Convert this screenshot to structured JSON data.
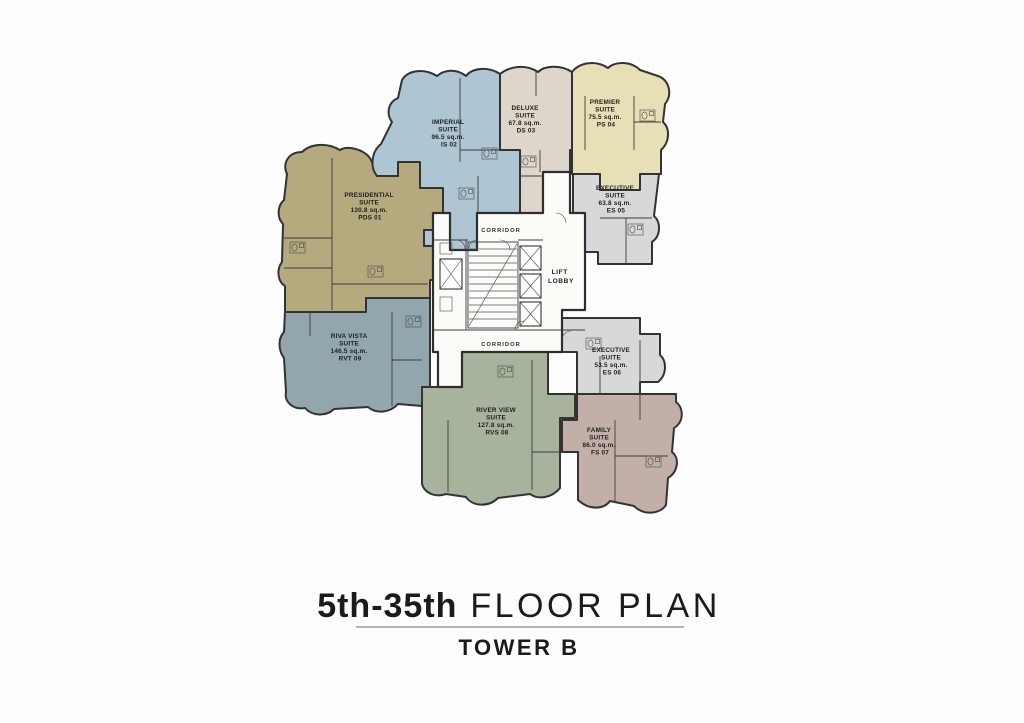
{
  "page": {
    "background_color": "#fdfdfd"
  },
  "title_block": {
    "range": "5th-35th",
    "label": " FLOOR PLAN",
    "tower": "TOWER B"
  },
  "core": {
    "corridor_top": "CORRIDOR",
    "corridor_bottom": "CORRIDOR",
    "lift_lobby": [
      "LIFT",
      "LOBBY"
    ]
  },
  "wall_color": "#333333",
  "units": [
    {
      "id": "presidential-suite",
      "lines": [
        "PRESIDENTIAL",
        "SUITE",
        "130.8 sq.m.",
        "PDS 01"
      ],
      "color": "#b4aa7d"
    },
    {
      "id": "imperial-suite",
      "lines": [
        "IMPERIAL",
        "SUITE",
        "96.5 sq.m.",
        "IS 02"
      ],
      "color": "#aec5d3"
    },
    {
      "id": "deluxe-suite",
      "lines": [
        "DELUXE",
        "SUITE",
        "67.8 sq.m.",
        "DS 03"
      ],
      "color": "#ded6ca"
    },
    {
      "id": "premier-suite",
      "lines": [
        "PREMIER",
        "SUITE",
        "75.5 sq.m.",
        "PS 04"
      ],
      "color": "#e7dfb5"
    },
    {
      "id": "executive-suite-es05",
      "lines": [
        "EXECUTIVE",
        "SUITE",
        "63.8 sq.m.",
        "ES 05"
      ],
      "color": "#d8d8db"
    },
    {
      "id": "executive-suite-es06",
      "lines": [
        "EXECUTIVE",
        "SUITE",
        "53.5 sq.m.",
        "ES 06"
      ],
      "color": "#d8d8db"
    },
    {
      "id": "family-suite",
      "lines": [
        "FAMILY",
        "SUITE",
        "86.0 sq.m.",
        "FS 07"
      ],
      "color": "#c2b0a8"
    },
    {
      "id": "river-view-suite",
      "lines": [
        "RIVER VIEW",
        "SUITE",
        "127.8 sq.m.",
        "RVS 08"
      ],
      "color": "#a8b39e"
    },
    {
      "id": "riva-vista-suite",
      "lines": [
        "RIVA VISTA",
        "SUITE",
        "146.5 sq.m.",
        "RVT 09"
      ],
      "color": "#91a6ad"
    }
  ]
}
